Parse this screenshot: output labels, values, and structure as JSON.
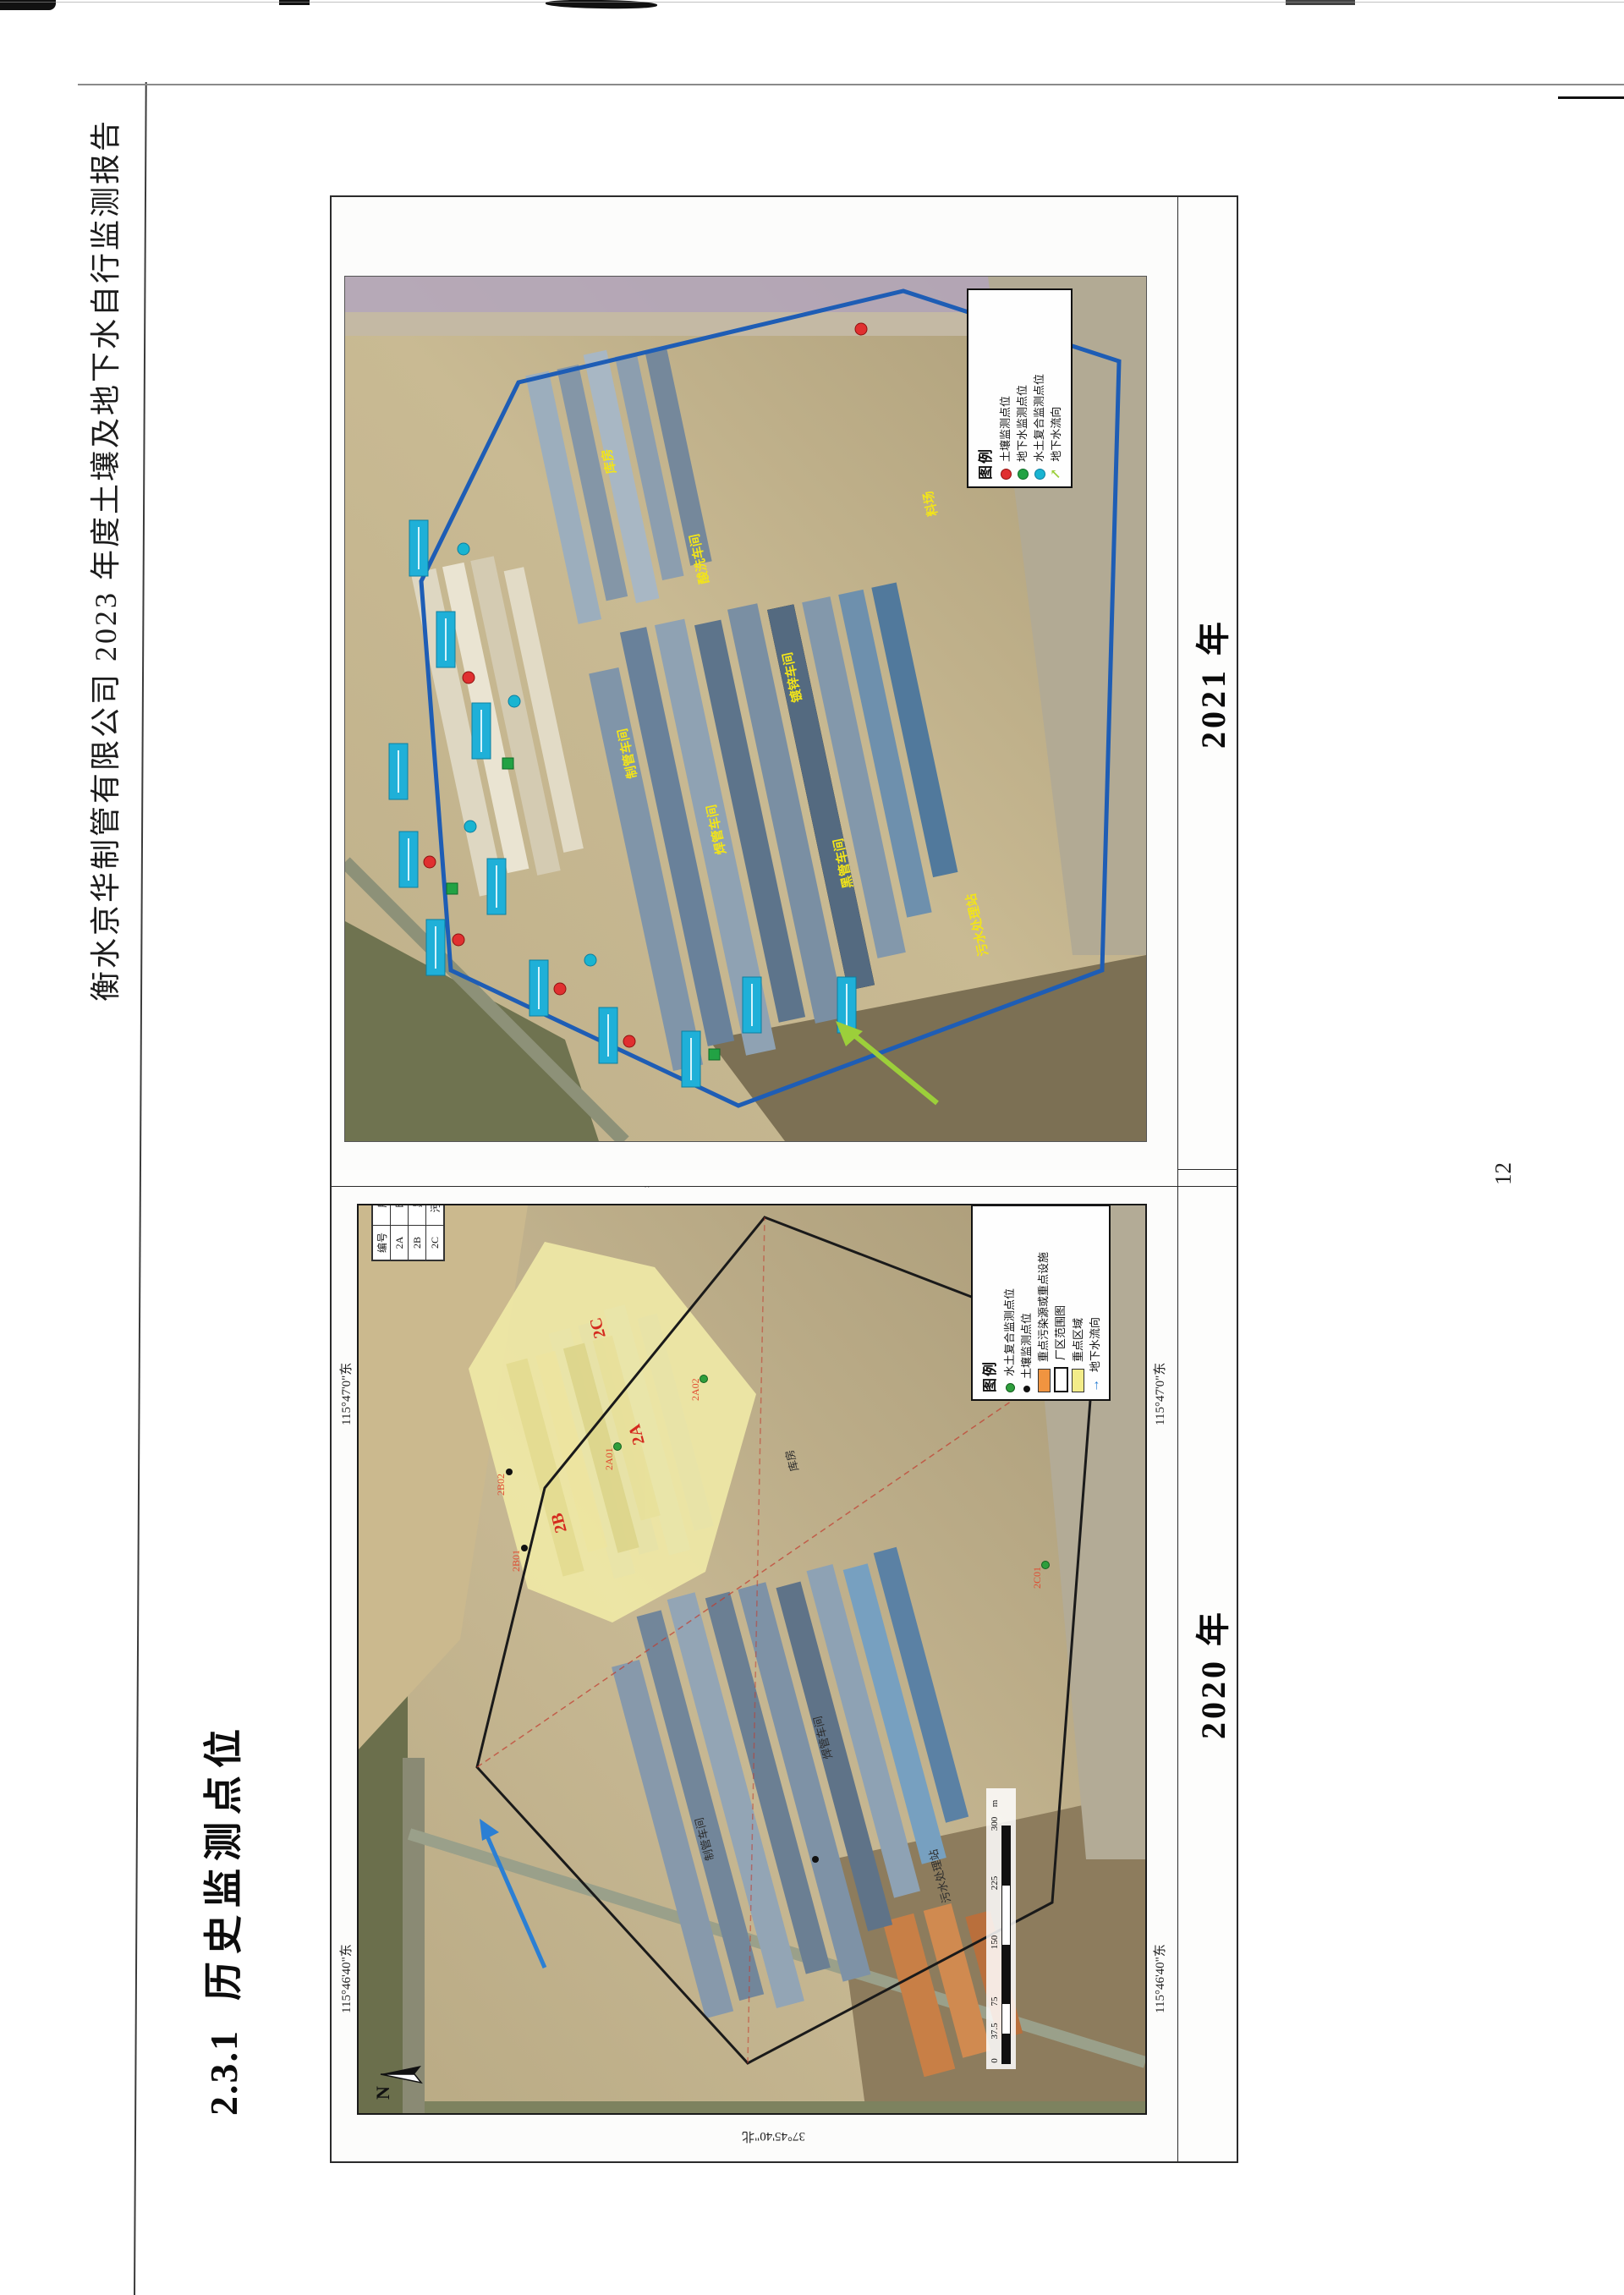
{
  "page": {
    "number": "12"
  },
  "header": {
    "title": "衡水京华制管有限公司 2023 年度土壤及地下水自行监测报告"
  },
  "heading": {
    "number": "2.3.1",
    "title": "历史监测点位"
  },
  "figure": {
    "caption_2020": "2020 年",
    "caption_2021": "2021 年"
  },
  "map2020": {
    "coordinates": {
      "lat": "37°45'40\"北",
      "lon_left": "115°46'40\"东",
      "lon_right": "115°47'0\"东"
    },
    "table": {
      "headers": [
        "编号",
        "所在区域"
      ],
      "rows": [
        [
          "2A",
          "暖气片厂"
        ],
        [
          "2B",
          "黑管车间"
        ],
        [
          "2C",
          "污水处理站"
        ]
      ]
    },
    "legend": {
      "title": "图例",
      "items": [
        {
          "symbol": "green-dot",
          "label": "水土复合监测点位"
        },
        {
          "symbol": "black-dot",
          "label": "土壤监测点位"
        },
        {
          "symbol": "orange-rect",
          "label": "重点污染源或重点设施"
        },
        {
          "symbol": "outline-rect",
          "label": "厂区范围图"
        },
        {
          "symbol": "yellow-rect",
          "label": "重点区域"
        },
        {
          "symbol": "blue-arrow",
          "label": "地下水流向"
        }
      ]
    },
    "scalebar": {
      "ticks": [
        "0",
        "37.5",
        "75",
        "150",
        "225",
        "300"
      ],
      "unit": "m"
    },
    "north_label": "N",
    "zone_labels": [
      "2A",
      "2B",
      "2C"
    ],
    "point_labels": [
      "2B01",
      "2B02",
      "2A01",
      "2A02",
      "2C01"
    ],
    "building_labels": [
      "制管车间",
      "焊管车间",
      "库房",
      "污水处理站"
    ]
  },
  "map2021": {
    "legend": {
      "title": "图例",
      "items": [
        {
          "symbol": "red-dot",
          "label": "土壤监测点位"
        },
        {
          "symbol": "green-dot",
          "label": "地下水监测点位"
        },
        {
          "symbol": "cyan-dot",
          "label": "水土复合监测点位"
        },
        {
          "symbol": "green-arrow",
          "label": "地下水流向"
        }
      ]
    },
    "building_labels": [
      "制管车间",
      "焊管车间",
      "镀锌车间",
      "黑管车间",
      "酸洗车间",
      "库房",
      "料场",
      "污水处理站"
    ]
  }
}
